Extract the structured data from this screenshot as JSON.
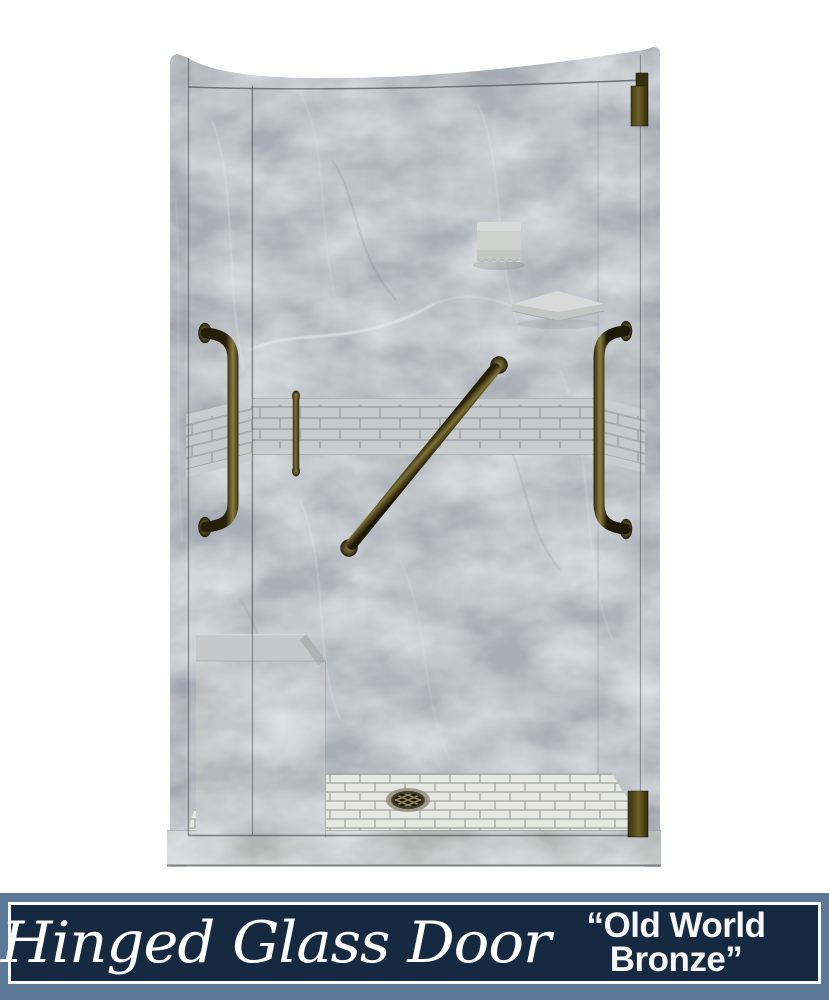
{
  "banner": {
    "product_type": "Hinged Glass Door",
    "finish_name_line1": "“Old World",
    "finish_name_line2": "Bronze”",
    "finish_name_full": "“Old World Bronze”"
  },
  "illustration": {
    "colors": {
      "marble_grey": "#a6abb3",
      "accent_tile_grey": "#c7c9ca",
      "floor_tile_white": "#e8e7e2",
      "bronze_hardware": "#6d6230",
      "banner_navy": "#152a41",
      "banner_frame_blue": "#5b7997"
    }
  }
}
